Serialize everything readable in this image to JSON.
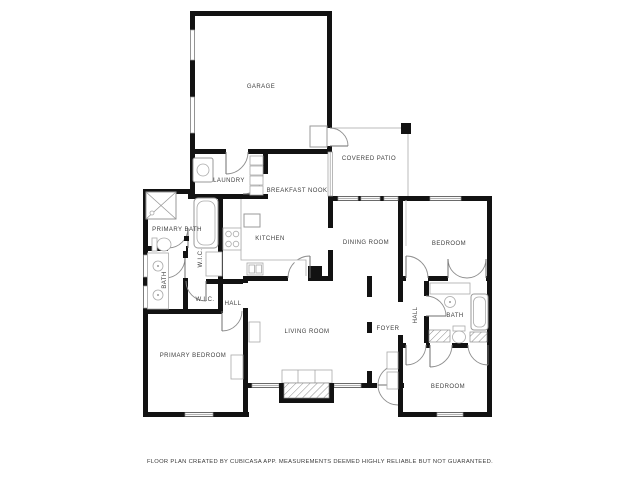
{
  "plan": {
    "type": "residential-floor-plan",
    "colors": {
      "wall": "#121212",
      "fixture_outline": "#9a9a9a",
      "label": "#3f3f3f",
      "background": "#ffffff"
    }
  },
  "rooms": [
    {
      "name": "garage",
      "label": "GARAGE"
    },
    {
      "name": "covered-patio",
      "label": "COVERED PATIO"
    },
    {
      "name": "laundry",
      "label": "LAUNDRY"
    },
    {
      "name": "breakfast-nook",
      "label": "BREAKFAST NOOK"
    },
    {
      "name": "primary-bath",
      "label": "PRIMARY BATH"
    },
    {
      "name": "kitchen",
      "label": "KITCHEN"
    },
    {
      "name": "dining-room",
      "label": "DINING ROOM"
    },
    {
      "name": "bedroom-top-right",
      "label": "BEDROOM"
    },
    {
      "name": "wic-upper",
      "label": "W.I.C."
    },
    {
      "name": "bath-left",
      "label": "BATH"
    },
    {
      "name": "wic-lower",
      "label": "W.I.C."
    },
    {
      "name": "hall-left",
      "label": "HALL"
    },
    {
      "name": "living-room",
      "label": "LIVING ROOM"
    },
    {
      "name": "foyer",
      "label": "FOYER"
    },
    {
      "name": "hall-right",
      "label": "HALL"
    },
    {
      "name": "bath-right",
      "label": "BATH"
    },
    {
      "name": "primary-bedroom",
      "label": "PRIMARY BEDROOM"
    },
    {
      "name": "bedroom-bottom-right",
      "label": "BEDROOM"
    }
  ],
  "fixtures": [
    "shower",
    "bathtub",
    "toilet",
    "sink",
    "washer",
    "pantry-shelves",
    "stove",
    "kitchen-sink",
    "kitchen-counter",
    "refrigerator-cabinet",
    "fireplace",
    "hearth",
    "dresser",
    "closet-shelving",
    "utility-units",
    "patio-post"
  ],
  "footer": {
    "disclaimer": "FLOOR PLAN CREATED BY CUBICASA APP. MEASUREMENTS DEEMED HIGHLY RELIABLE BUT NOT GUARANTEED."
  }
}
